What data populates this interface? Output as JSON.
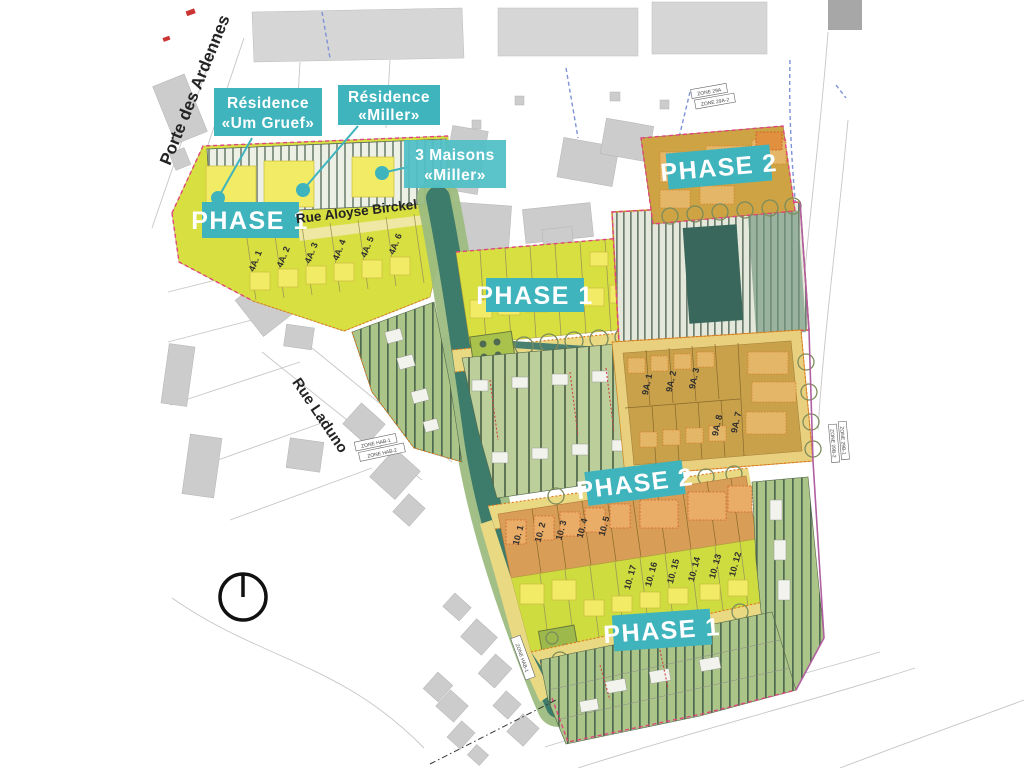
{
  "plan": {
    "streets": {
      "porte_des_ardennes": "Porte des Ardennes",
      "rue_aloyse_birckel": "Rue Aloyse Birckel",
      "rue_laduno": "Rue Laduno"
    },
    "projects": {
      "um_gruef": {
        "line1": "Résidence",
        "line2": "«Um Gruef»"
      },
      "miller": {
        "line1": "Résidence",
        "line2": "«Miller»"
      },
      "maisons_miller": {
        "line1": "3 Maisons",
        "line2": "«Miller»"
      }
    },
    "phases": {
      "phase1": "PHASE 1",
      "phase2": "PHASE 2"
    },
    "lots": {
      "a4": [
        "4A. 1",
        "4A. 2",
        "4A. 3",
        "4A. 4",
        "4A. 5",
        "4A. 6"
      ],
      "a9": [
        "9A. 1",
        "9A. 2",
        "9A. 3",
        "9A. 8",
        "9A. 7"
      ],
      "b10_upper": [
        "10. 1",
        "10. 2",
        "10. 3",
        "10. 4",
        "10. 5"
      ],
      "b10_lower": [
        "10. 17",
        "10. 16",
        "10. 15",
        "10. 14",
        "10. 13",
        "10. 12"
      ]
    },
    "zone_labels": [
      "ZONE 29A",
      "ZONE 29A-2",
      "ZONE HAB-1",
      "ZONE HAB-2",
      "ZONE HAB-1",
      "ZONE 29B-1",
      "ZONE 29B-2"
    ],
    "icons": {
      "north_indicator": "north-circle-icon"
    },
    "colors": {
      "badge_teal": "#3fb4bd",
      "badge_teal_light": "#4fbfc7",
      "phase1_chartreuse": "#d8df41",
      "phase2_tan": "#c9a14b",
      "block_orange": "#d89d56",
      "garden_green": "#abc488",
      "hedge_dark_green": "#3d7b6b",
      "road_yellow": "#ead983",
      "boundary_red": "#e0457b",
      "boundary_orange": "#e07818",
      "boundary_magenta": "#b05fa0",
      "context_gray": "#cccccc"
    }
  }
}
